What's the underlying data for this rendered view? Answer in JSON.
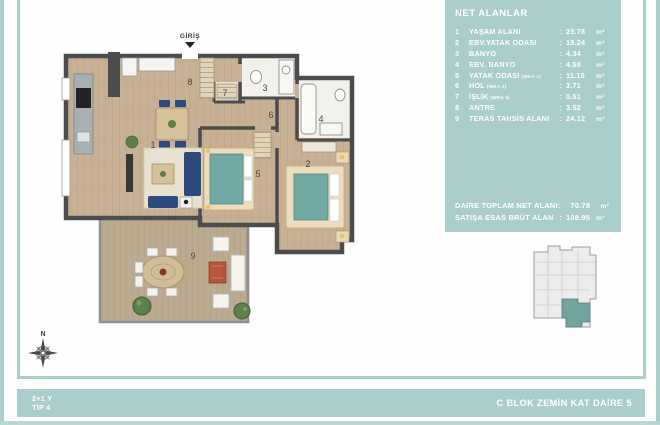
{
  "colors": {
    "teal_panel": "#a9cecb",
    "teal_unit_highlight": "#72a39f",
    "wall": "#4c4c4c",
    "wood_floor": "#c7b093",
    "deck_floor": "#bdab91",
    "bed_teal": "#73a9a5",
    "sofa_navy": "#2d4a7e",
    "text_white": "#ffffff"
  },
  "panel": {
    "title": "NET ALANLAR",
    "colon": ":",
    "unit": "m²",
    "rows": [
      {
        "num": "1",
        "label": "YAŞAM ALANI",
        "sub": "",
        "value": "23.78"
      },
      {
        "num": "2",
        "label": "EBV.YATAK ODASI",
        "sub": "",
        "value": "19.24"
      },
      {
        "num": "3",
        "label": "BANYO",
        "sub": "",
        "value": "4.34"
      },
      {
        "num": "4",
        "label": "EBV. BANYO",
        "sub": "",
        "value": "4.58"
      },
      {
        "num": "5",
        "label": "YATAK ODASI",
        "sub": "(WKA 1)",
        "value": "11.10"
      },
      {
        "num": "6",
        "label": "HOL",
        "sub": "(WKA 2)",
        "value": "3.71"
      },
      {
        "num": "7",
        "label": "İŞLİK",
        "sub": "(WKA 6)",
        "value": "0.51"
      },
      {
        "num": "8",
        "label": "ANTRE",
        "sub": "",
        "value": "3.52"
      },
      {
        "num": "9",
        "label": "TERAS TAHSİS ALANI",
        "sub": "",
        "value": "24.12"
      }
    ],
    "totals": [
      {
        "label": "DAİRE TOPLAM NET ALANI:",
        "colon": "",
        "value": "70.78",
        "unit": "m²"
      },
      {
        "label": "SATIŞA ESAS BRÜT ALAN",
        "colon": ":",
        "value": "108.95",
        "unit": "m²"
      }
    ]
  },
  "footer": {
    "type_line1": "2+1 Y",
    "type_line2": "TİP 4",
    "location": "C BLOK ZEMİN KAT DAİRE 5"
  },
  "plan": {
    "entry_label": "GİRİŞ",
    "compass_label": "N",
    "room_numbers": [
      "1",
      "2",
      "3",
      "4",
      "5",
      "6",
      "7",
      "8",
      "9"
    ]
  }
}
